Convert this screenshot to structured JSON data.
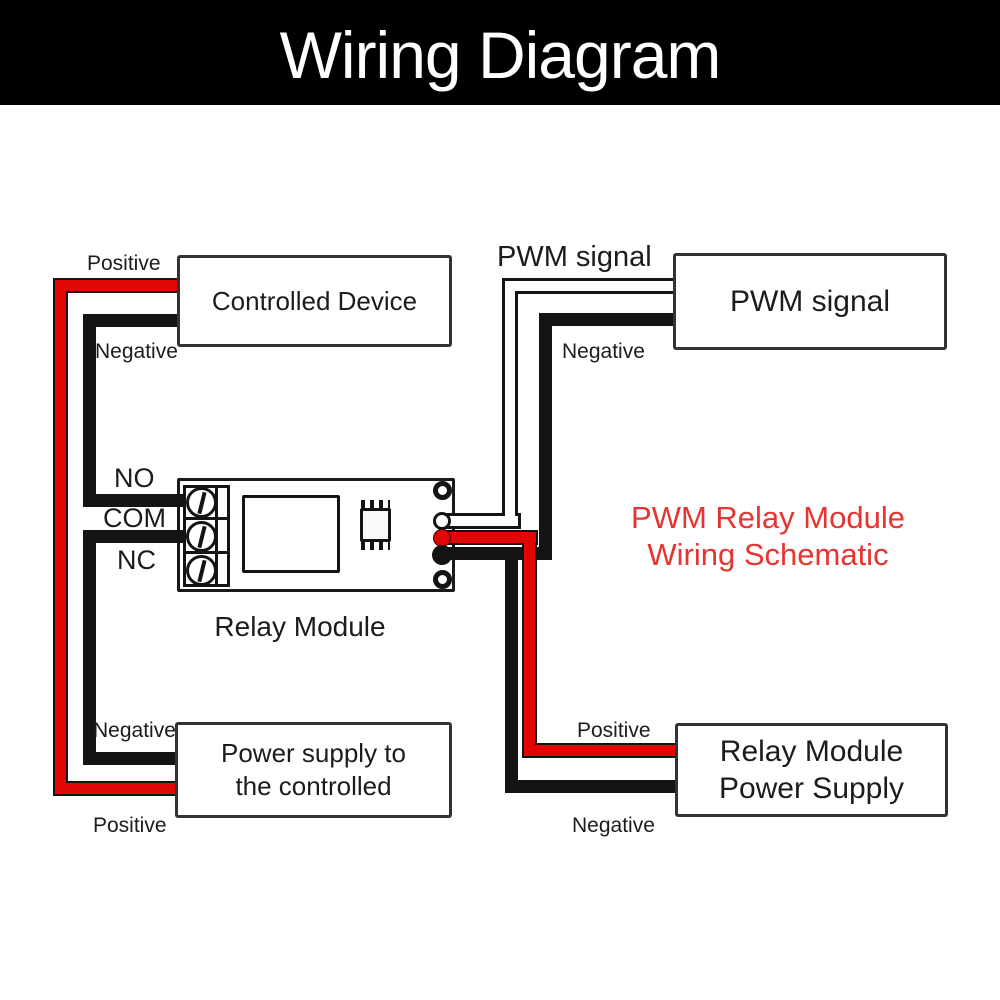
{
  "header": {
    "title": "Wiring Diagram"
  },
  "boxes": {
    "controlled_device": {
      "label": "Controlled Device"
    },
    "pwm_signal": {
      "label": "PWM signal"
    },
    "power_supply_controlled": {
      "label_line1": "Power supply to",
      "label_line2": "the controlled"
    },
    "relay_power_supply": {
      "label_line1": "Relay Module",
      "label_line2": "Power Supply"
    }
  },
  "labels": {
    "controlled_positive": "Positive",
    "controlled_negative": "Negative",
    "terminal_no": "NO",
    "terminal_com": "COM",
    "terminal_nc": "NC",
    "relay_module": "Relay Module",
    "pwm_wire": "PWM signal",
    "pwm_negative": "Negative",
    "relay_supply_positive": "Positive",
    "relay_supply_negative": "Negative",
    "controlled_supply_negative": "Negative",
    "controlled_supply_positive": "Positive"
  },
  "title_annotation": {
    "line1": "PWM Relay Module",
    "line2": "Wiring Schematic"
  },
  "colors": {
    "header_bg": "#000000",
    "header_text": "#ffffff",
    "background": "#ffffff",
    "text": "#1c1c1c",
    "box_border": "#333333",
    "wire_red": "#e10505",
    "wire_black": "#141414",
    "wire_white": "#ffffff",
    "title_red": "#e63430"
  }
}
